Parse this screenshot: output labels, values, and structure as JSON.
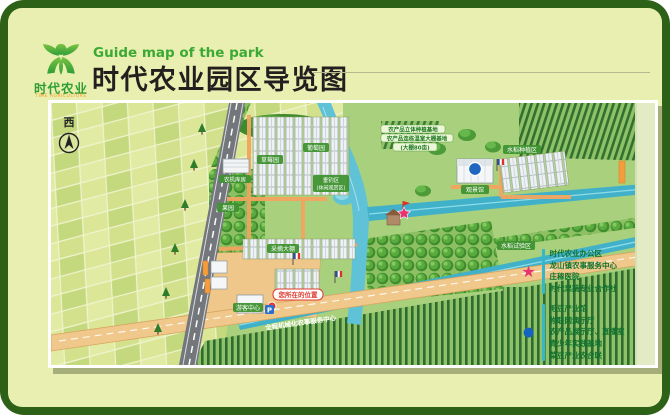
{
  "header": {
    "logo": {
      "brand": "时代农业",
      "subtext": "TIME AGRICULTURE"
    },
    "subtitle_en": "Guide map of the park",
    "title_zh": "时代农业园区导览图",
    "accent_green": "#3aaa35"
  },
  "compass": {
    "label": "西"
  },
  "map": {
    "labels": {
      "strawberry": "草莓园",
      "grape": "葡萄园",
      "machinery": "农机库房",
      "orchard": "果园",
      "picking": "采摘大棚",
      "fishing1": "垂钓区",
      "fishing2": "(休闲观赏区)",
      "visitor": "游客中心",
      "viewing": "观景馆",
      "rice_planting": "水稻种植区",
      "rice_trial": "水稻试验区",
      "service_road": "全程机械化农事服务中心",
      "you_are_here": "您所在的位置",
      "anno1": "农产品立体种植基地",
      "anno2": "农产品连栋温室大棚基地",
      "anno3": "(大棚80亩)",
      "parking": "P"
    }
  },
  "legend": {
    "star_marker": "★",
    "star_color": "#e8336e",
    "star_items": [
      "时代农业办公区",
      "龙山镇农事服务中心",
      "庄稼医院",
      "时代果蔬专业合作社"
    ],
    "dot_marker": "●",
    "dot_color": "#1565c0",
    "dot_items": [
      "毛豆产业馆",
      "物联网演示厅",
      "农产品展示厅、直播室",
      "青少年实践基地",
      "菜豆产业农合联"
    ]
  }
}
